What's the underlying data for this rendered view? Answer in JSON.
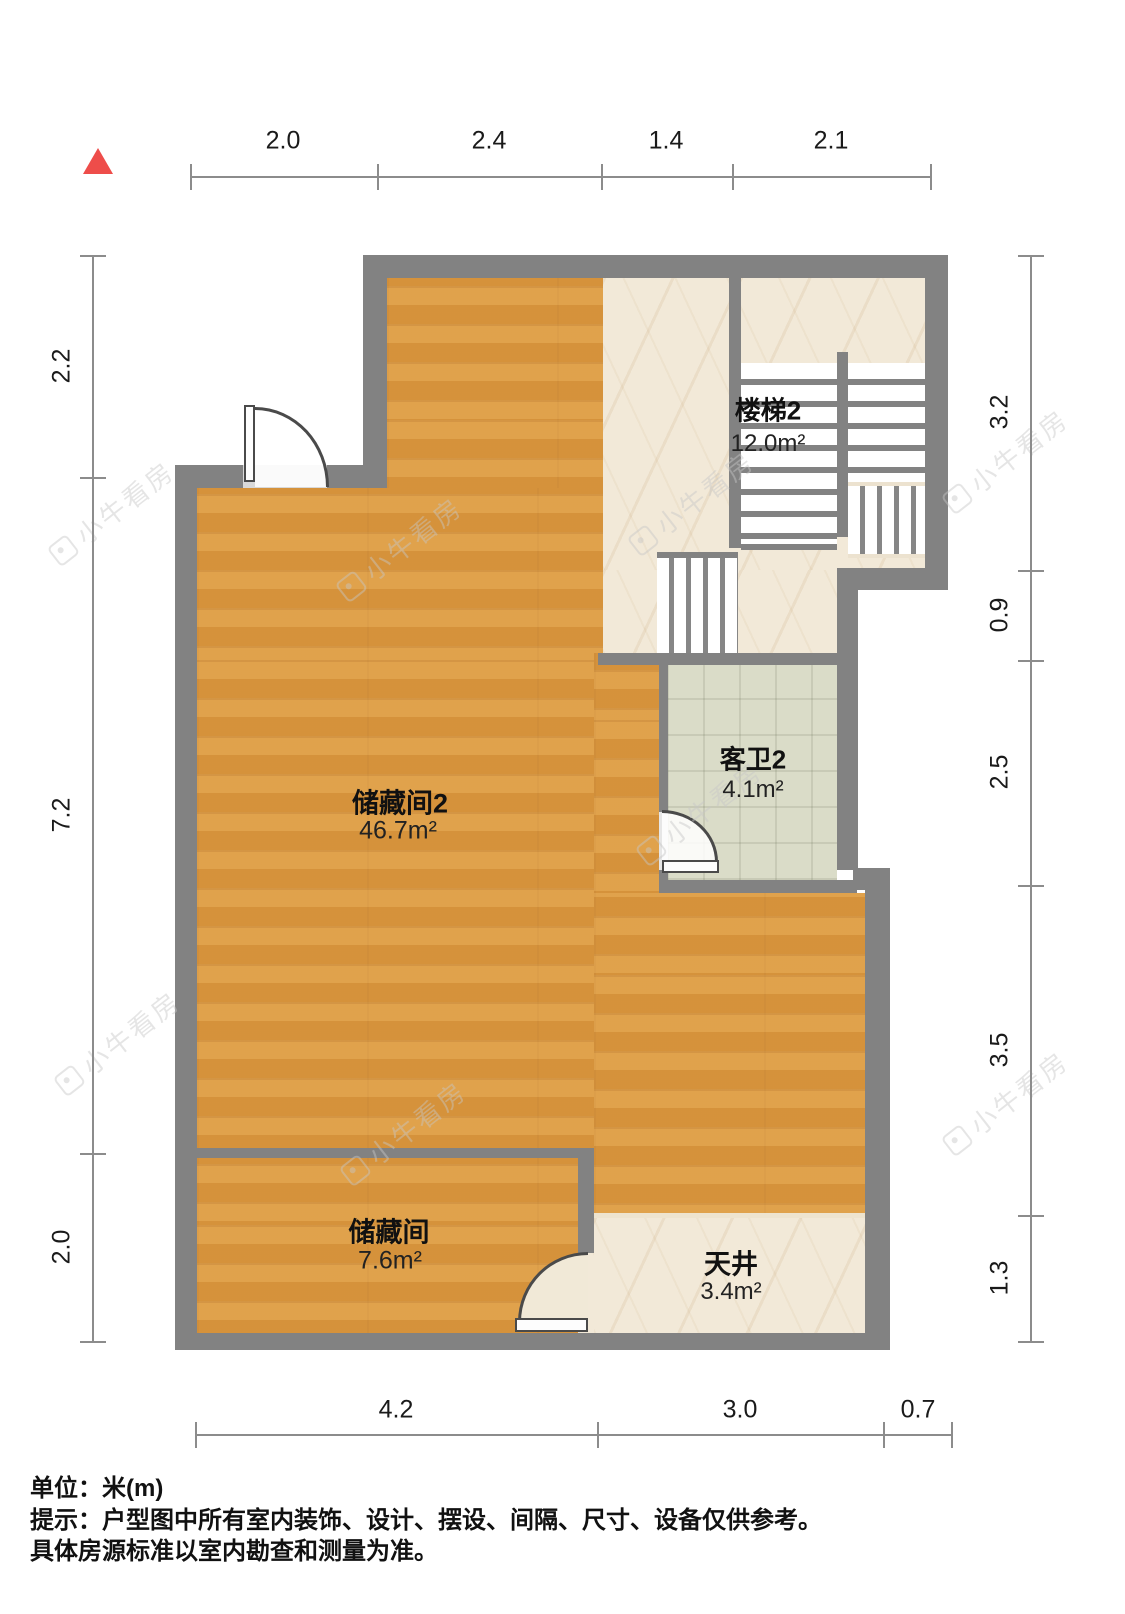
{
  "north_indicator": {
    "icon": "north-triangle",
    "color": "#ee4d4a"
  },
  "watermark": {
    "text": "小牛看房"
  },
  "rooms": [
    {
      "id": "staircase2",
      "name": "楼梯2",
      "area": "12.0m²"
    },
    {
      "id": "guest-bath2",
      "name": "客卫2",
      "area": "4.1m²"
    },
    {
      "id": "storage2",
      "name": "储藏间2",
      "area": "46.7m²"
    },
    {
      "id": "storage",
      "name": "储藏间",
      "area": "7.6m²"
    },
    {
      "id": "patio",
      "name": "天井",
      "area": "3.4m²"
    }
  ],
  "dimensions": {
    "top": [
      "2.0",
      "2.4",
      "1.4",
      "2.1"
    ],
    "left": [
      "2.2",
      "7.2",
      "2.0"
    ],
    "right": [
      "3.2",
      "0.9",
      "2.5",
      "3.5",
      "1.3"
    ],
    "bottom": [
      "4.2",
      "3.0",
      "0.7"
    ]
  },
  "footer": {
    "unit_line": "单位：米(m)",
    "note_line1": "提示：户型图中所有室内装饰、设计、摆设、间隔、尺寸、设备仅供参考。",
    "note_line2": "具体房源标准以室内勘查和测量为准。"
  },
  "colors": {
    "wall": "#828282",
    "wood_floor": "#dc9a40",
    "stone_floor": "#f2e9d8",
    "bath_tile": "#dadcc8",
    "accent_red": "#ee4d4a",
    "dimension_line": "#8c8c8c"
  }
}
